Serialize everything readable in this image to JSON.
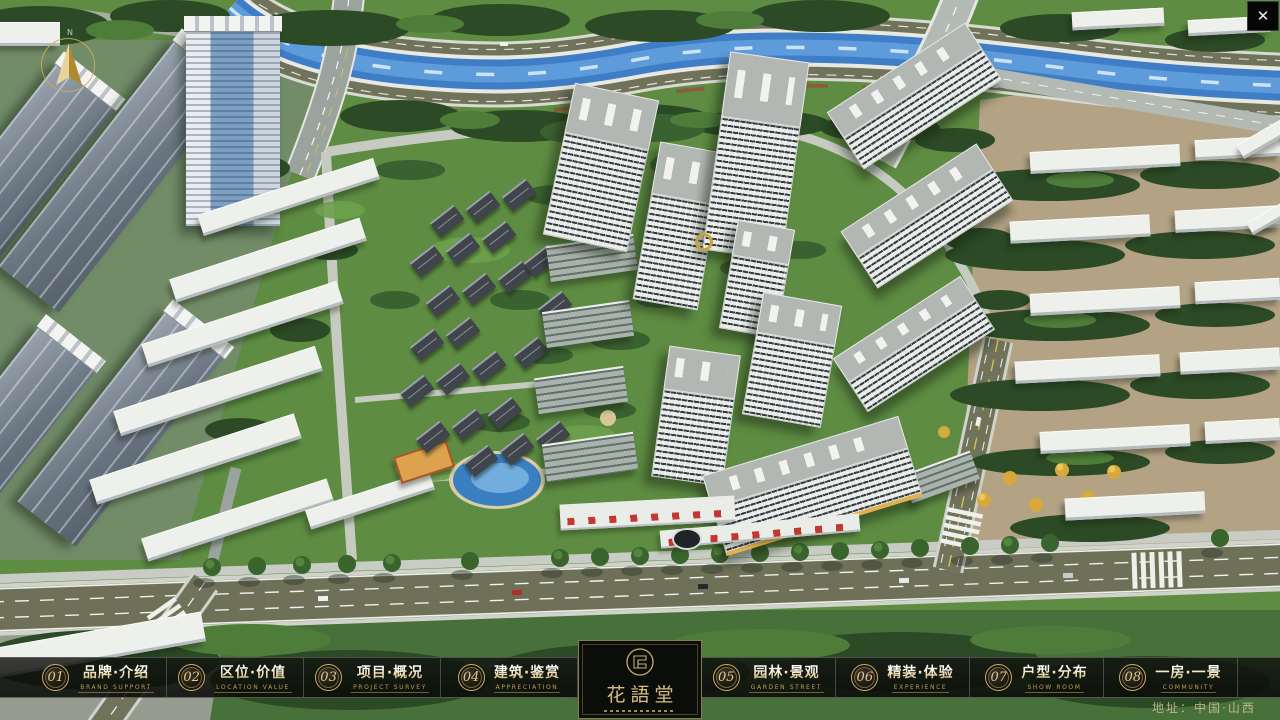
{
  "window": {
    "close_glyph": "✕"
  },
  "compass": {
    "north_label": "N"
  },
  "nav": {
    "items": [
      {
        "num": "01",
        "zh": "品牌·介绍",
        "en": "BRAND SUPPORT"
      },
      {
        "num": "02",
        "zh": "区位·价值",
        "en": "LOCATION VALUE"
      },
      {
        "num": "03",
        "zh": "项目·概况",
        "en": "PROJECT SURVEY"
      },
      {
        "num": "04",
        "zh": "建筑·鉴赏",
        "en": "APPRECIATION"
      },
      {
        "num": "05",
        "zh": "园林·景观",
        "en": "GARDEN STREET"
      },
      {
        "num": "06",
        "zh": "精装·体验",
        "en": "EXPERIENCE"
      },
      {
        "num": "07",
        "zh": "户型·分布",
        "en": "SHOW ROOM"
      },
      {
        "num": "08",
        "zh": "一房·一景",
        "en": "COMMUNITY"
      }
    ]
  },
  "logo": {
    "title": "花語堂"
  },
  "watermark": {
    "text": "地址：中国·山西"
  },
  "colors": {
    "gold": "#c9ad6a",
    "river": "#3f7ec6",
    "grass": "#5d8c42",
    "road": "#6e7058"
  }
}
